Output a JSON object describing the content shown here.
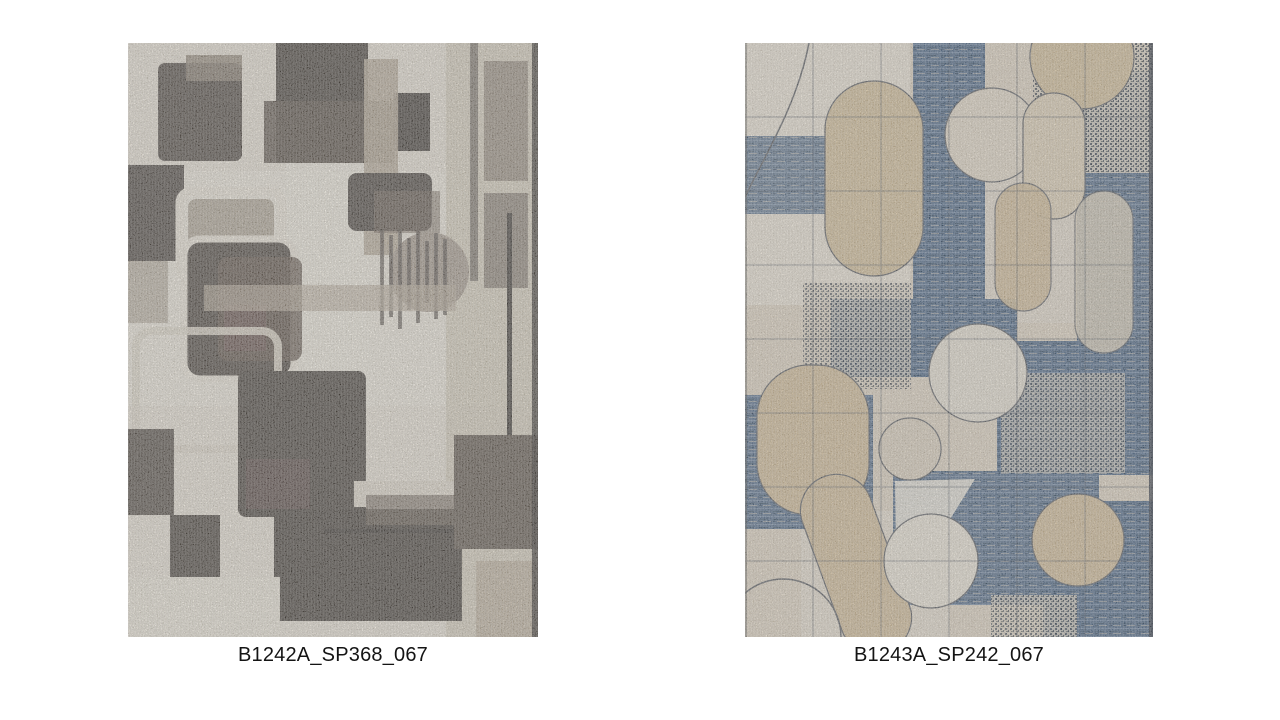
{
  "page": {
    "background_color": "#ffffff"
  },
  "products": [
    {
      "label": "B1242A_SP368_067",
      "palette": {
        "background": "#e7e0d2",
        "charcoal": "#47403a",
        "brown": "#5d5046",
        "taupe": "#a2968a",
        "light_taupe": "#cfc5b1",
        "cream": "#eae4d6"
      }
    },
    {
      "label": "B1243A_SP242_067",
      "palette": {
        "background": "#d6cbb8",
        "blue": "#48617f",
        "tan": "#c9b490",
        "cream": "#e1dacc",
        "grid_dark": "#39414d"
      }
    }
  ]
}
